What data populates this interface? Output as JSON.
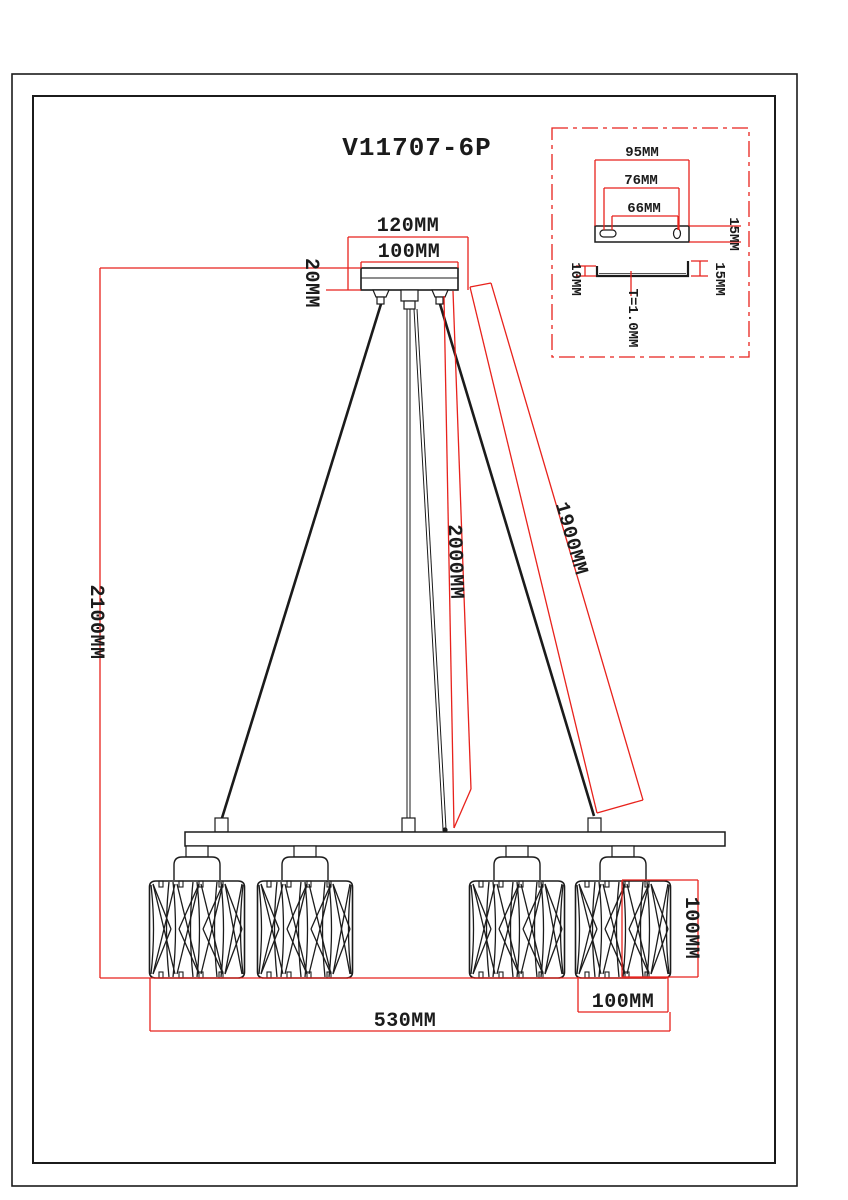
{
  "drawing": {
    "title": "V11707-6P",
    "colors": {
      "dimension_red": "#e8221c",
      "line_black": "#1b1b1b"
    },
    "canopy": {
      "outer_width": "120MM",
      "inner_width": "100MM",
      "height": "20MM"
    },
    "drop": {
      "overall_height": "2100MM",
      "center_rod": "2000MM",
      "cable": "1900MM"
    },
    "shade": {
      "height": "100MM",
      "width": "100MM"
    },
    "ring": {
      "overall_width": "530MM"
    },
    "bracket_detail": {
      "outer_width": "95MM",
      "hole_span": "76MM",
      "inner_span": "66MM",
      "plate_depth": "15MM",
      "lip_left": "10MM",
      "lip_right": "15MM",
      "thickness": "T=1.0MM"
    }
  }
}
